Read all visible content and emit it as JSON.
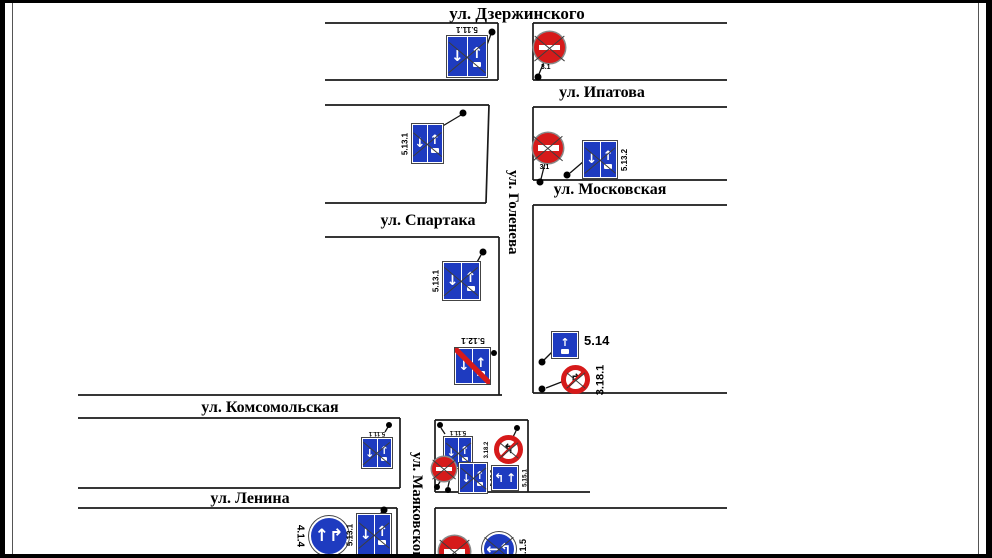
{
  "scheme": {
    "streets": {
      "dzerzhinskogo": "ул. Дзержинского",
      "ipatova": "ул. Ипатова",
      "moskovskaya": "ул. Московская",
      "spartaka": "ул. Спартака",
      "goleneva": "ул. Голенева",
      "komsomolskaya": "ул. Комсомольская",
      "lenina": "ул. Ленина",
      "mayakovskogo": "ул. Маяковского"
    },
    "signs": {
      "s1": {
        "code": "5.11.1",
        "crossed": true
      },
      "s2": {
        "code": "3.1",
        "crossed": true
      },
      "s3": {
        "code": "5.13.1",
        "crossed": true
      },
      "s4": {
        "code": "3.1",
        "crossed": true
      },
      "s5": {
        "code": "5.13.2",
        "crossed": true
      },
      "s6": {
        "code": "5.13.1",
        "crossed": true
      },
      "s7": {
        "code": "5.12.1",
        "crossed": false
      },
      "s8": {
        "code": "5.14",
        "crossed": false
      },
      "s9": {
        "code": "3.18.1",
        "crossed": true
      },
      "s10": {
        "code": "5.11.1",
        "crossed": true
      },
      "s11": {
        "code": "5.11.1",
        "crossed": true
      },
      "s12": {
        "code": "3.18.2",
        "crossed": true
      },
      "s13": {
        "code": "3.1",
        "crossed": true
      },
      "s14": {
        "code": "5.13.2",
        "crossed": true
      },
      "s15": {
        "code": "5.15.1",
        "crossed": false
      },
      "s16": {
        "code": "4.1.4",
        "crossed": false
      },
      "s17": {
        "code": "5.13.1",
        "crossed": true
      },
      "s18": {
        "code": "3.1",
        "crossed": true
      },
      "s19": {
        "code": "4.1.5",
        "crossed": true
      }
    },
    "colors": {
      "sign_blue": "#1e3bc0",
      "sign_red": "#d61a1a"
    }
  }
}
